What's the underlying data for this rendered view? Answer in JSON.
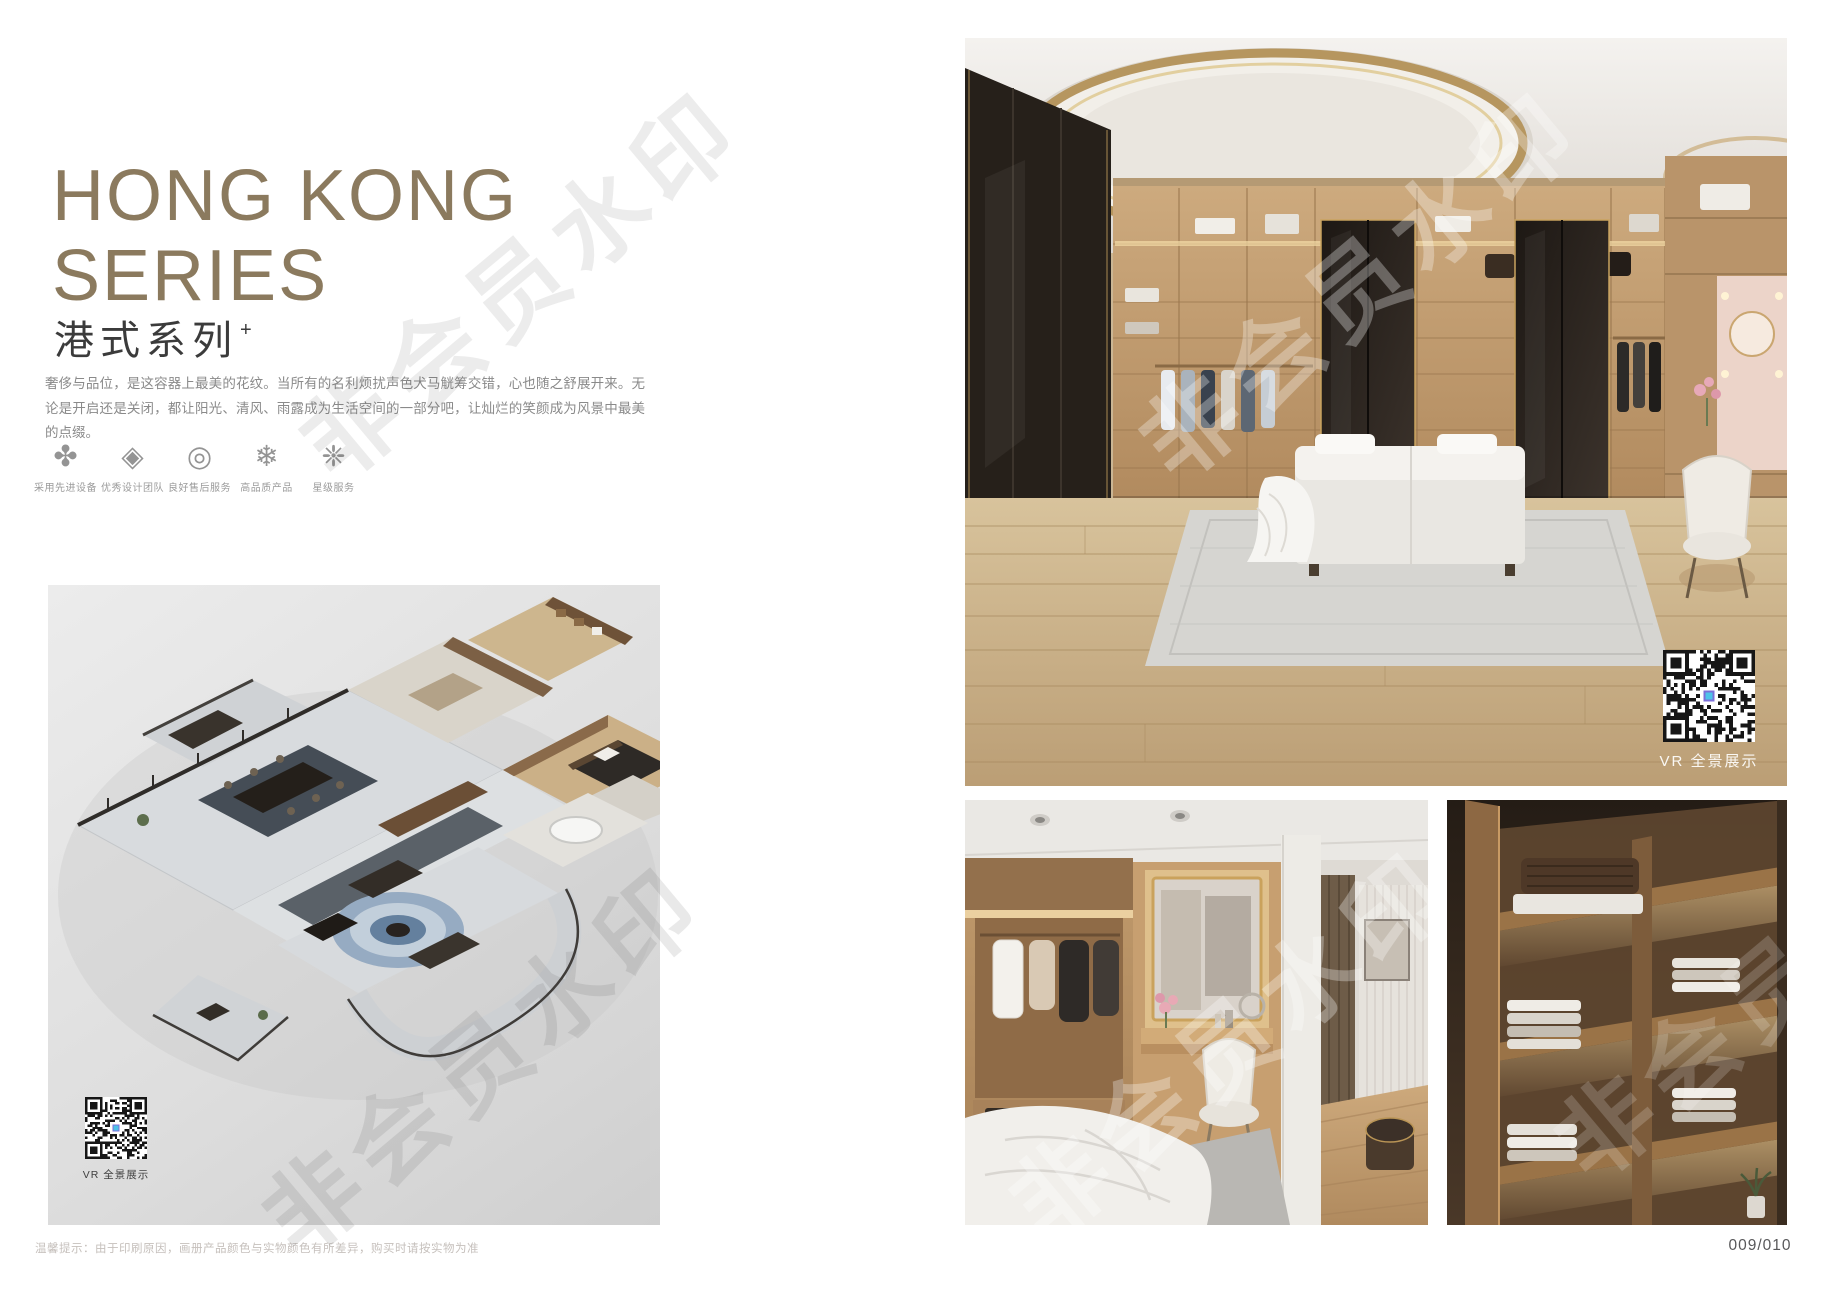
{
  "watermark_text": "非会员水印",
  "left_page": {
    "title_line1": "HONG KONG",
    "title_line2": "SERIES",
    "subtitle_cn": "港式系列",
    "subtitle_superscript": "+",
    "description": "奢侈与品位，是这容器上最美的花纹。当所有的名利烦扰声色犬马觥筹交错，心也随之舒展开来。无论是开启还是关闭，都让阳光、清风、雨露成为生活空间的一部分吧，让灿烂的笑颜成为风景中最美的点缀。",
    "features": [
      {
        "name": "advanced-equipment",
        "glyph": "✤",
        "label": "采用先进设备"
      },
      {
        "name": "design-team",
        "glyph": "◈",
        "label": "优秀设计团队"
      },
      {
        "name": "after-sales-service",
        "glyph": "◎",
        "label": "良好售后服务"
      },
      {
        "name": "quality-product",
        "glyph": "❄",
        "label": "高品质产品"
      },
      {
        "name": "star-service",
        "glyph": "❈",
        "label": "星级服务"
      }
    ],
    "floorplan_vr_label": "VR 全景展示",
    "footer_note": "温馨提示：由于印刷原因，画册产品颜色与实物颜色有所差异，购买时请按实物为准"
  },
  "right_page": {
    "top_photo_vr_label": "VR 全景展示",
    "page_number": "009/010"
  },
  "colors": {
    "title_gold": "#8b7a5e",
    "subtitle_dark": "#3b3b3b",
    "body_gray": "#8a8a8a",
    "footer_gray": "#c6c0bc"
  }
}
